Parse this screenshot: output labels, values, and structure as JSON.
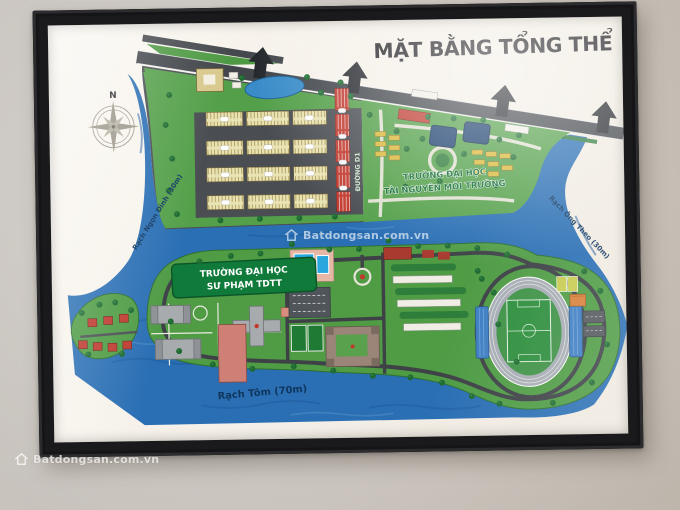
{
  "map": {
    "title": "MẶT BẰNG TỔNG THỂ",
    "compass": {
      "north": "N"
    },
    "roads": {
      "boulevard": "ĐƯỜNG SỐ 7",
      "d1": "ĐƯỜNG D1"
    },
    "zones": {
      "right_campus": {
        "line1": "TRƯỜNG ĐẠI HỌC",
        "line2": "TÀI NGUYÊN MÔI TRƯỜNG"
      },
      "left_campus": {
        "line1": "TRƯỜNG ĐẠI HỌC",
        "line2": "SƯ PHẠM TDTT"
      }
    },
    "waterways": {
      "bottom": "Rạch Tôm (70m)",
      "left": "Rạch Ngọn Đình (30m)",
      "right": "Rạch Ông Theo (30m)"
    },
    "colors": {
      "water": "#2a6fb4",
      "land_green": "#54a04a",
      "road_gray": "#4a4e53",
      "housing_cream": "#e9e3b4",
      "housing_red": "#c23a2f",
      "sign_green": "#0f7a3a",
      "stand_blue": "#3f7fc3",
      "frame_black": "#1a1a1c"
    }
  },
  "watermark": {
    "text": "Batdongsan.com.vn"
  }
}
